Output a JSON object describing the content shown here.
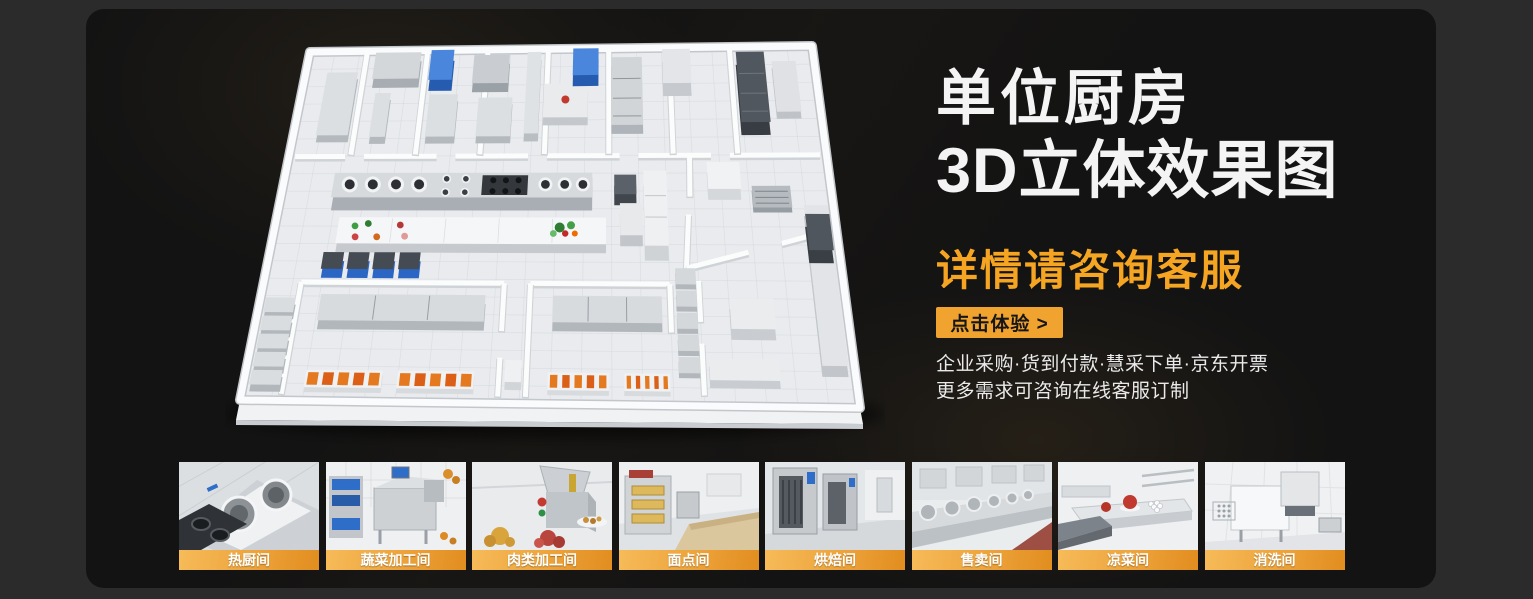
{
  "hero": {
    "title_line1": "单位厨房",
    "title_line2": "3D立体效果图",
    "subtitle": "详情请咨询客服",
    "cta_label": "点击体验 >",
    "info_line1": "企业采购·货到付款·慧采下单·京东开票",
    "info_line2": "更多需求可咨询在线客服订制"
  },
  "colors": {
    "accent_orange": "#f5a522",
    "cta_background": "#f0a42f",
    "label_band_start": "#f6bb59",
    "label_band_end": "#e18d1f",
    "panel_background": "#131313",
    "outer_background": "#2b2b2c"
  },
  "thumbnails": [
    {
      "label": "热厨间"
    },
    {
      "label": "蔬菜加工间"
    },
    {
      "label": "肉类加工间"
    },
    {
      "label": "面点间"
    },
    {
      "label": "烘焙间"
    },
    {
      "label": "售卖间"
    },
    {
      "label": "凉菜间"
    },
    {
      "label": "消洗间"
    }
  ]
}
